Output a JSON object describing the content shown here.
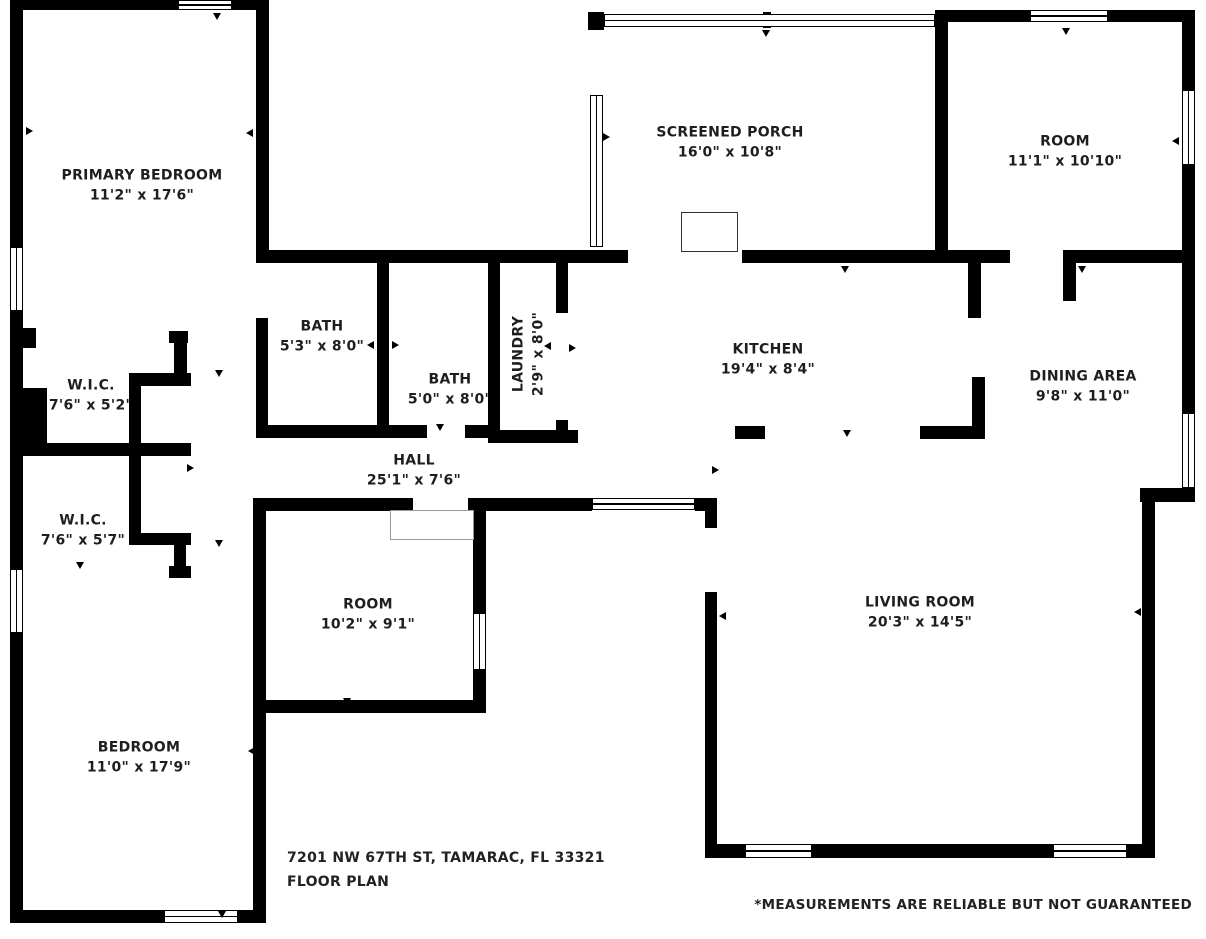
{
  "floor_plan": {
    "rooms": [
      {
        "name": "PRIMARY BEDROOM",
        "dims": "11'2\" x 17'6\""
      },
      {
        "name": "SCREENED PORCH",
        "dims": "16'0\" x 10'8\""
      },
      {
        "name": "ROOM",
        "dims": "11'1\" x 10'10\""
      },
      {
        "name": "BATH",
        "dims": "5'3\" x 8'0\""
      },
      {
        "name": "BATH",
        "dims": "5'0\" x 8'0\""
      },
      {
        "name": "LAUNDRY",
        "dims": "2'9\" x 8'0\""
      },
      {
        "name": "KITCHEN",
        "dims": "19'4\" x 8'4\""
      },
      {
        "name": "DINING AREA",
        "dims": "9'8\" x 11'0\""
      },
      {
        "name": "W.I.C.",
        "dims": "7'6\" x 5'2\""
      },
      {
        "name": "W.I.C.",
        "dims": "7'6\" x 5'7\""
      },
      {
        "name": "HALL",
        "dims": "25'1\" x 7'6\""
      },
      {
        "name": "ROOM",
        "dims": "10'2\" x 9'1\""
      },
      {
        "name": "LIVING ROOM",
        "dims": "20'3\" x 14'5\""
      },
      {
        "name": "BEDROOM",
        "dims": "11'0\" x 17'9\""
      }
    ],
    "footer": {
      "address": "7201 NW 67TH ST, TAMARAC, FL 33321",
      "plan_label": "FLOOR PLAN",
      "disclaimer": "*MEASUREMENTS ARE RELIABLE BUT NOT GUARANTEED"
    },
    "colors": {
      "wall": "#000000",
      "text": "#1e1e1e",
      "background": "#ffffff"
    }
  }
}
